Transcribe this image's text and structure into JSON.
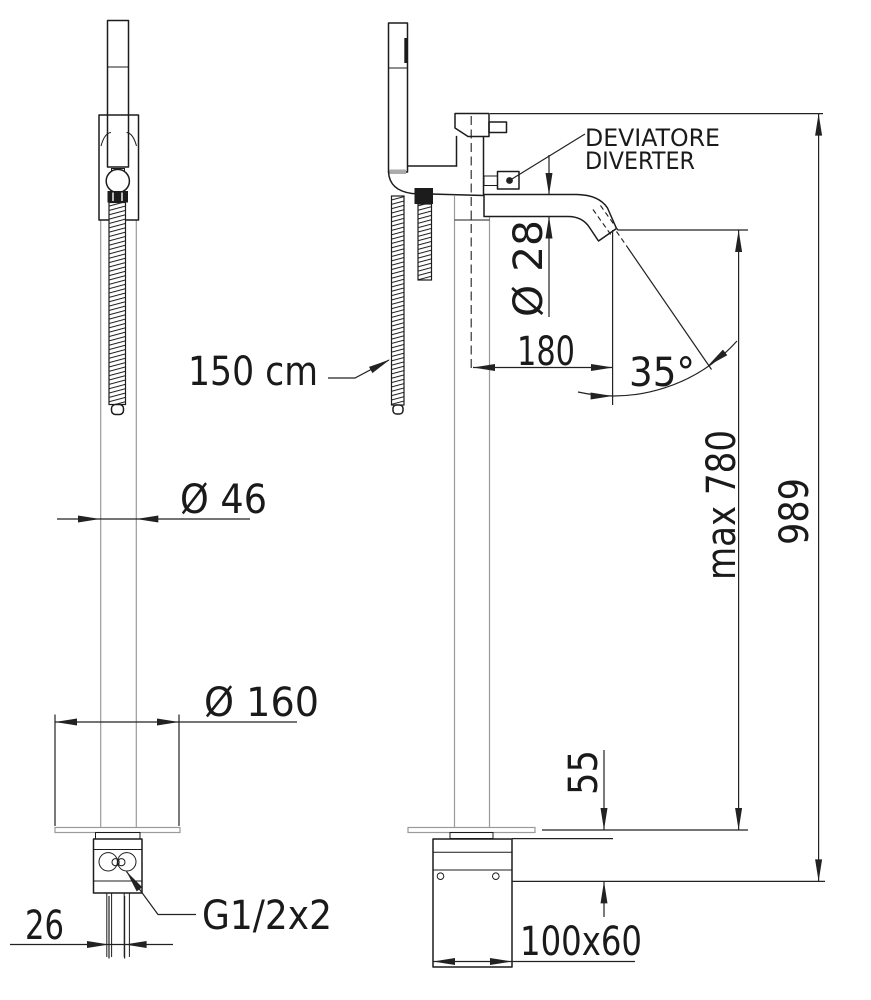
{
  "drawing": {
    "type": "technical dimension drawing",
    "subject": "freestanding floor-mounted bath mixer with hand shower (front and side views)",
    "labels": {
      "hose_length": "150 cm",
      "column_diameter": "Ø 46",
      "base_plate_diameter": "Ø 160",
      "inlet_spacing": "26",
      "inlet_thread": "G1/2x2",
      "spout_diameter": "Ø 28",
      "spout_reach": "180",
      "spout_angle": "35°",
      "spout_height_max": "max 780",
      "total_height": "989",
      "floor_box_offset": "55",
      "mounting_box_size": "100x60",
      "diverter_label_it": "DEVIATORE",
      "diverter_label_en": "DIVERTER"
    },
    "colors": {
      "outline": "#1c1c1c",
      "dimension_lines": "#222222",
      "construction_lines": "#9a9a9a",
      "background": "#ffffff"
    }
  }
}
